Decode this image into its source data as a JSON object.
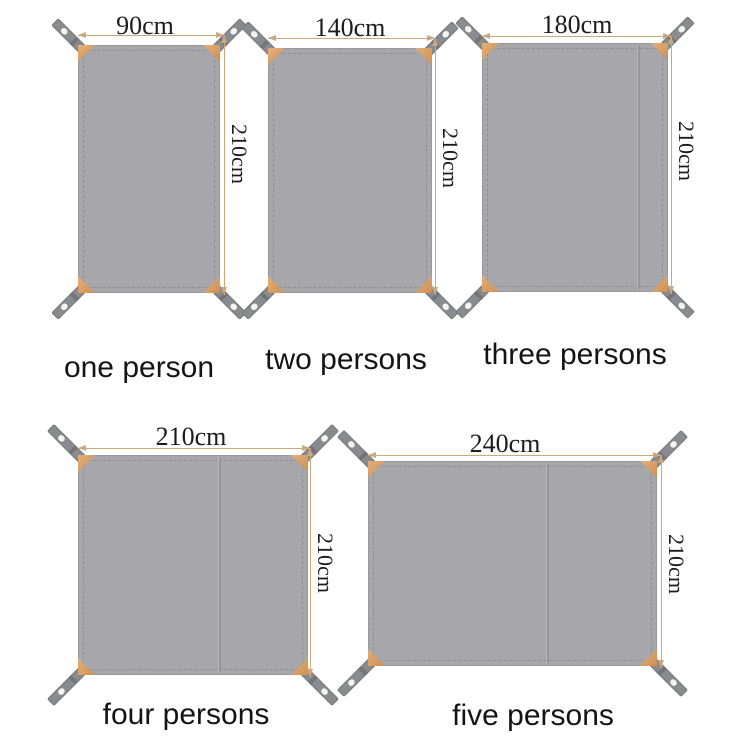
{
  "colors": {
    "tarp_gray": "#a7a7ab",
    "strap_gray": "#8a8b8f",
    "corner_patch_orange": "#d3965c",
    "dimension_line_tan": "#cfa87a",
    "text_black": "#1c1c1c",
    "background": "#ffffff"
  },
  "mats": [
    {
      "caption": "one person",
      "width_label": "90cm",
      "height_label": "210cm"
    },
    {
      "caption": "two persons",
      "width_label": "140cm",
      "height_label": "210cm"
    },
    {
      "caption": "three persons",
      "width_label": "180cm",
      "height_label": "210cm"
    },
    {
      "caption": "four persons",
      "width_label": "210cm",
      "height_label": "210cm"
    },
    {
      "caption": "five persons",
      "width_label": "240cm",
      "height_label": "210cm"
    }
  ]
}
